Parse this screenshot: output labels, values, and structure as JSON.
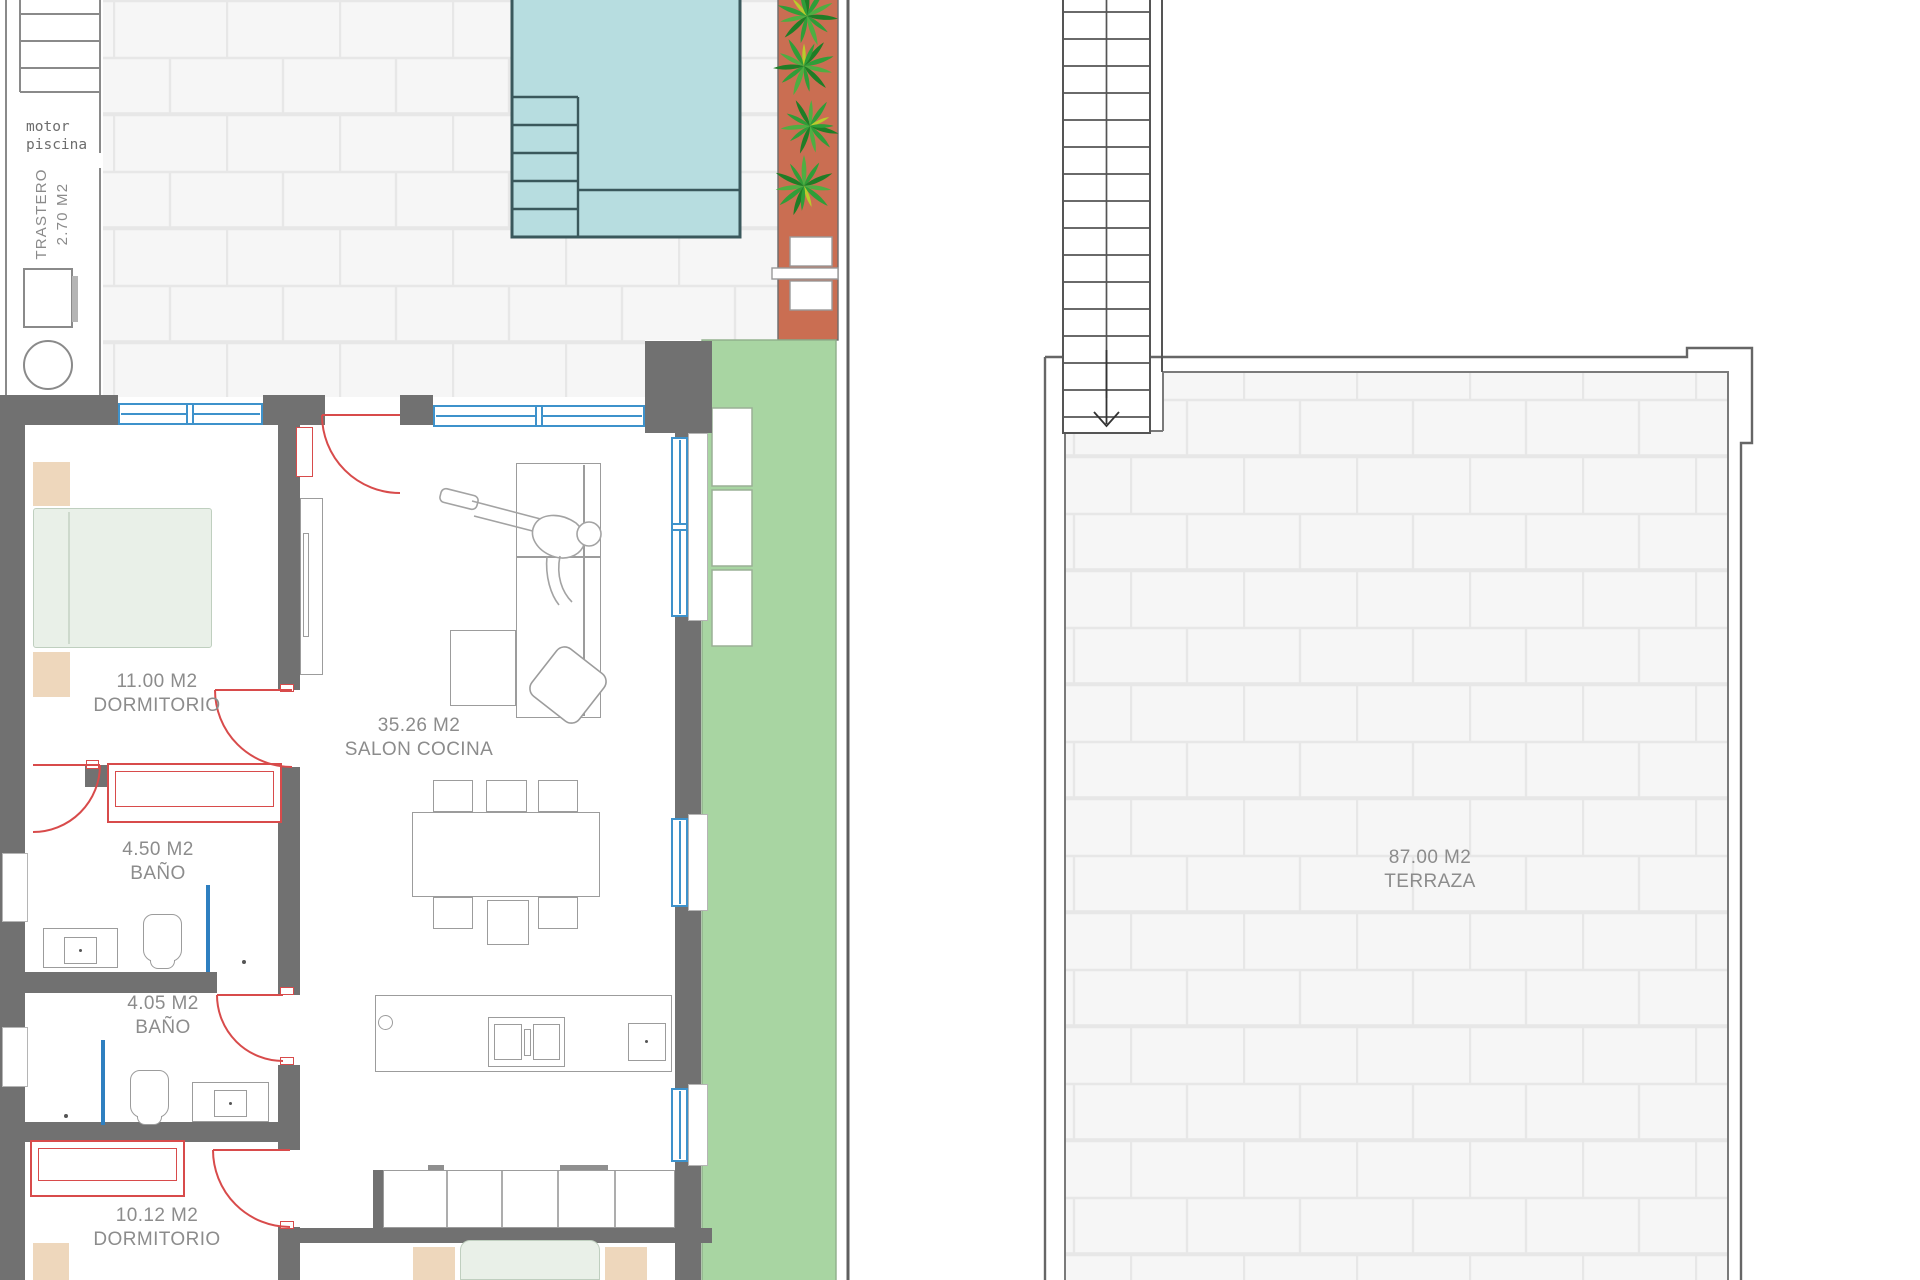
{
  "plan": {
    "type": "residential floor plan, two panels: ground floor with pool garden (left) and roof terrace with stair (right)"
  },
  "labels": {
    "motor": {
      "line1": "motor",
      "line2": "piscina"
    },
    "trastero": {
      "line1": "TRASTERO",
      "line2": "2.70 M2"
    },
    "rooms": [
      {
        "id": "dormitorio1",
        "area": "11.00 M2",
        "name": "DORMITORIO"
      },
      {
        "id": "salon",
        "area": "35.26 M2",
        "name": "SALON COCINA"
      },
      {
        "id": "bano1",
        "area": "4.50 M2",
        "name": "BAÑO"
      },
      {
        "id": "bano2",
        "area": "4.05 M2",
        "name": "BAÑO"
      },
      {
        "id": "dormitorio2",
        "area": "10.12 M2",
        "name": "DORMITORIO"
      },
      {
        "id": "terraza",
        "area": "87.00 M2",
        "name": "TERRAZA"
      }
    ]
  },
  "palette": {
    "wall": "#717171",
    "pool_fill": "#b7dde0",
    "pool_edge": "#3a585c",
    "terracotta": "#ca6e52",
    "grass": "#a8d5a2",
    "plant_green_dark": "#1f7d26",
    "plant_green": "#2f9e38",
    "plant_green_light": "#4fae42",
    "door_red": "#d84b4b",
    "window_blue": "#3e92cb",
    "shower_blue": "#2e7fc0",
    "brick_bg": "#f6f6f6",
    "brick_line": "#e7e7e7",
    "furniture_line": "#9c9c9c",
    "label_gray": "#8c8c8c",
    "bed_beige": "#eed7bc",
    "mattress_green": "#e9f0e8"
  }
}
